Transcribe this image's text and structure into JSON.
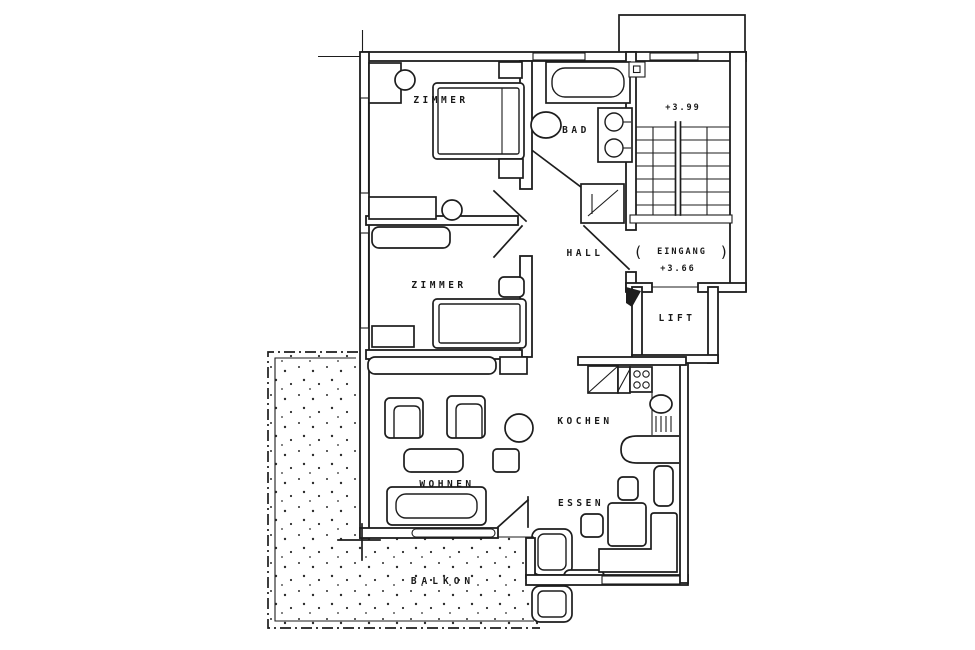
{
  "plan": {
    "type": "apartment-floor-plan",
    "rooms": {
      "zimmer1": "ZIMMER",
      "zimmer2": "ZIMMER",
      "bad": "BAD",
      "hall": "HALL",
      "eingang": "EINGANG",
      "lift": "LIFT",
      "kochen": "KOCHEN",
      "wohnen": "WOHNEN",
      "essen": "ESSEN",
      "balkon": "BALKON"
    },
    "levels": {
      "stairwell": "+3.99",
      "entrance": "+3.66"
    },
    "door_marks": {
      "left": "(",
      "right": ")"
    },
    "colors": {
      "ink": "#1d1d1d",
      "paper": "#ffffff"
    }
  }
}
